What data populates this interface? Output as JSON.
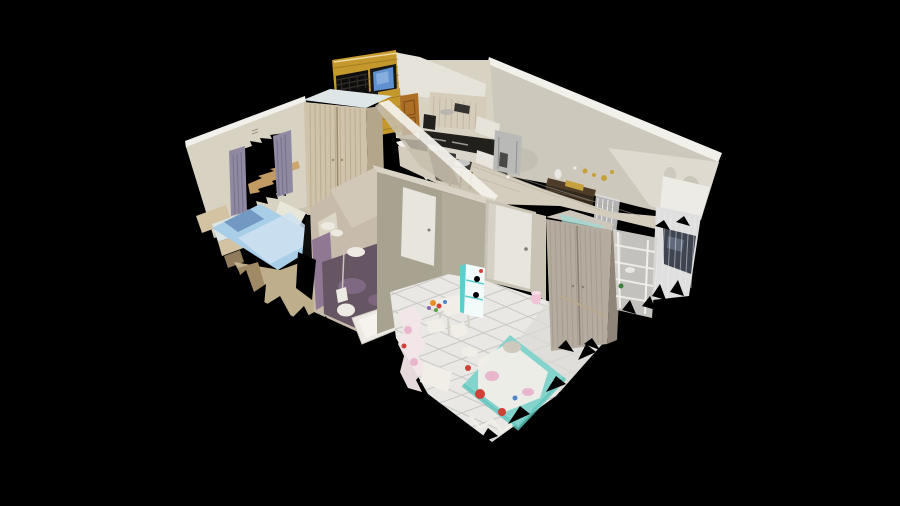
{
  "viewer": {
    "background": "#000000",
    "type": "3d-dollhouse-cutaway-scan"
  },
  "scene": {
    "style": "photogrammetry dollhouse view of an apartment, top-down oblique angle, ragged scan edges on black",
    "rooms": [
      {
        "name": "bedroom",
        "position": "left",
        "items": [
          "double-bed-blue",
          "wardrobe-beige",
          "window-with-purple-curtains",
          "bedside-bench"
        ]
      },
      {
        "name": "kitchen",
        "position": "top-center",
        "items": [
          "upper-cabinets",
          "black-counter-stove",
          "island-sink-stool",
          "stainless-fridge",
          "wooden-door",
          "brick-column"
        ]
      },
      {
        "name": "balcony",
        "position": "top",
        "items": [
          "yellow-brick-wall",
          "dark-railing",
          "wall-mounted-tv"
        ]
      },
      {
        "name": "bathroom",
        "position": "center-left",
        "items": [
          "sink",
          "toilet",
          "bathtub",
          "purple-floor"
        ]
      },
      {
        "name": "hallway",
        "position": "center",
        "items": [
          "white-door",
          "console-table",
          "gold-wall-decor",
          "sheer-curtain"
        ]
      },
      {
        "name": "kids-room",
        "position": "bottom-center",
        "items": [
          "colorful-bed",
          "white-play-table",
          "small-chairs",
          "teal-shelf",
          "gray-wardrobe",
          "white-rack",
          "pink-toys",
          "tiled-floor"
        ]
      }
    ]
  },
  "colors": {
    "black": "#000000",
    "near_black": "#0d0d0c",
    "wall_top": "#f2f0ea",
    "wall_cream": "#d8d2c3",
    "wall_cream_shade": "#c6bfae",
    "wall_long": "#cdc8bc",
    "wall_corner": "#e0ddd4",
    "wall_smudge": "#b5afa2",
    "wall_diag": "#c5beae",
    "olive": "#a8a291",
    "olive_light": "#bab4a3",
    "olive_rim": "#d8d3c5",
    "brick": "#c5982e",
    "brick_dark": "#8f6e1f",
    "brick_hi": "#ecd9a0",
    "railing": "#2e2b26",
    "door_wood": "#ad6e25",
    "door_wood_dark": "#7a4c14",
    "tv_frame": "#17171a",
    "tv_screen": "#6090cf",
    "tv_hi": "#8fb4e0",
    "cabinet_wood": "#d5ccba",
    "cabinet_stripe": "#b7ab93",
    "appliance_dark": "#22201d",
    "glint": "#b9b6af",
    "cab_lower": "#d9d5ca",
    "oven_dark": "#35332f",
    "stool_dark": "#3b3834",
    "stool_leg": "#8a6f46",
    "sink_steel": "#c6c6c4",
    "fridge": "#b9b9b7",
    "fridge_line": "#8f8f8d",
    "fridge_dark": "#4a4947",
    "floor_hall": "#d4cdbe",
    "floor_line": "#b5ad9c",
    "floor_dark": "#57534c",
    "backsplash": "#e6e3db",
    "door_white": "#e8e5de",
    "door_frame": "#c9c3b5",
    "door_shade": "#d5d1c6",
    "handle_gray": "#7f7b70",
    "wardrobe_beige": "#cfc3ab",
    "wardrobe_stripe": "#b1a184",
    "wardrobe_seam": "#9a8b6e",
    "wardrobe_side": "#b4a68b",
    "wardrobe_top": "#dfe6e8",
    "curtain": "#8f89a2",
    "curtain_streak": "#6b6582",
    "sill_tan": "#cca368",
    "mark": "#9a9488",
    "pillow_white": "#e9e6da",
    "bench_top": "#dce4e4",
    "bed_frame": "#d3c3a3",
    "wood_dark": "#a08a66",
    "bed_blue": "#a9cee8",
    "bed_blue_dark": "#7199c2",
    "bed_blue_light": "#cfe2f1",
    "floor_tan": "#c8b794",
    "bath_wall": "#c7bcab",
    "bath_wall_hi": "#d2c8b8",
    "mirror": "#ded8ca",
    "bath_purple": "#8a7090",
    "bath_dark": "#665663",
    "shower": "#77626e",
    "fixture_white": "#edeae3",
    "fixture_shade": "#cfccc3",
    "tub_inner": "#f6f4ee",
    "pipe": "#c9c4b8",
    "tile_white": "#e9e8e4",
    "tile_line": "#c9c8c4",
    "tile_shade": "#dbdad6",
    "kid_teal": "#84d4cd",
    "kid_teal_dark": "#5fc4bb",
    "kid_white": "#f1eee7",
    "kid_red": "#cf4136",
    "kid_pink": "#eab6cd",
    "plush": "#cfc8bd",
    "toy_orange": "#e78f28",
    "toy_blue": "#4f86c8",
    "toy_green": "#55a344",
    "toy_purple": "#8868b0",
    "toy_pink_light": "#f2e6e8",
    "shelf_teal": "#5ccfcc",
    "shelf_front": "#f2fbfa",
    "bucket_pink": "#f2c3d6",
    "bucket_rim": "#f9dce8",
    "wardrobe_gray": "#b5ab9e",
    "wardrobe_gray_stripe": "#9d9386",
    "wardrobe_gray_seam": "#8a8073",
    "wardrobe_gray_side": "#8f8679",
    "wardrobe_gray_top": "#cdc6ba",
    "glimpse": "#9fd8d4",
    "broom": "#b9a98e",
    "rack_bg": "#d8d6d2",
    "sheer": "#e0dfdf",
    "sheer_hi": "#f0efed",
    "dark_object": "#3e4450",
    "object_hi": "#6a7488",
    "end_wall": "#ecebe5",
    "console_dark": "#33291d",
    "console_top": "#4e3c28",
    "console_line": "#5a4836",
    "gold": "#c6a03c",
    "vase_white": "#e9e7e3",
    "plant_green": "#3f7d3d"
  }
}
